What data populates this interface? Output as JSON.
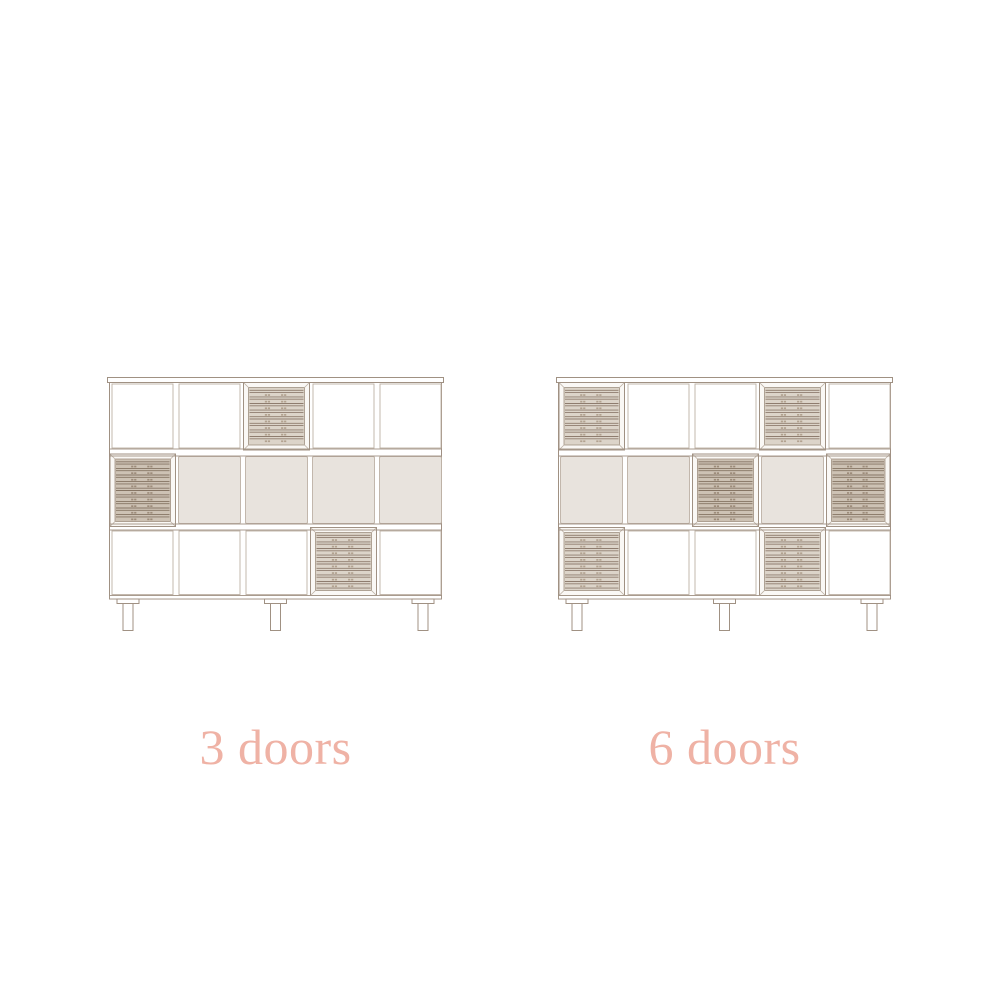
{
  "colors": {
    "background": "#ffffff",
    "outline": "#a09183",
    "outline_light": "#bdb1a5",
    "louver_line": "#8e7c6e",
    "louver_line_dark": "#857463",
    "slat_fill": "#dcd4c9",
    "slat_fill_dark": "#cdc2b4",
    "slat_dot": "#b2a290",
    "slat_dot_dark": "#9d8c7a",
    "panel_fill": "#e8e3dd",
    "door_frame_fill": "#faf8f5",
    "cell_fill": "#ffffff",
    "label_color": "#efb2a5"
  },
  "cabinets": [
    {
      "label": "3 doors",
      "grid": [
        [
          "open",
          "open",
          "door",
          "open",
          "open"
        ],
        [
          "door",
          "panel",
          "panel",
          "panel",
          "panel"
        ],
        [
          "open",
          "open",
          "open",
          "door",
          "open"
        ]
      ]
    },
    {
      "label": "6 doors",
      "grid": [
        [
          "door",
          "open",
          "open",
          "door",
          "open"
        ],
        [
          "panel",
          "panel",
          "door",
          "panel",
          "door"
        ],
        [
          "door",
          "open",
          "open",
          "door",
          "open"
        ]
      ]
    }
  ]
}
